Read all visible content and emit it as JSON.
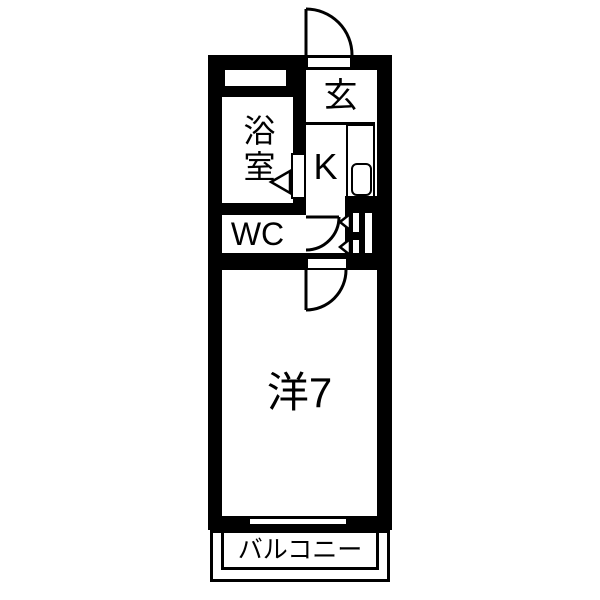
{
  "meta": {
    "type": "apartment-floor-plan",
    "background_color": "#ffffff",
    "wall_color": "#000000"
  },
  "rooms": {
    "genkan": {
      "label": "玄"
    },
    "bathroom": {
      "label": "浴室"
    },
    "kitchen": {
      "label": "K"
    },
    "wc": {
      "label": "WC"
    },
    "western_room": {
      "label": "洋7"
    },
    "balcony": {
      "label": "バルコニー"
    }
  }
}
